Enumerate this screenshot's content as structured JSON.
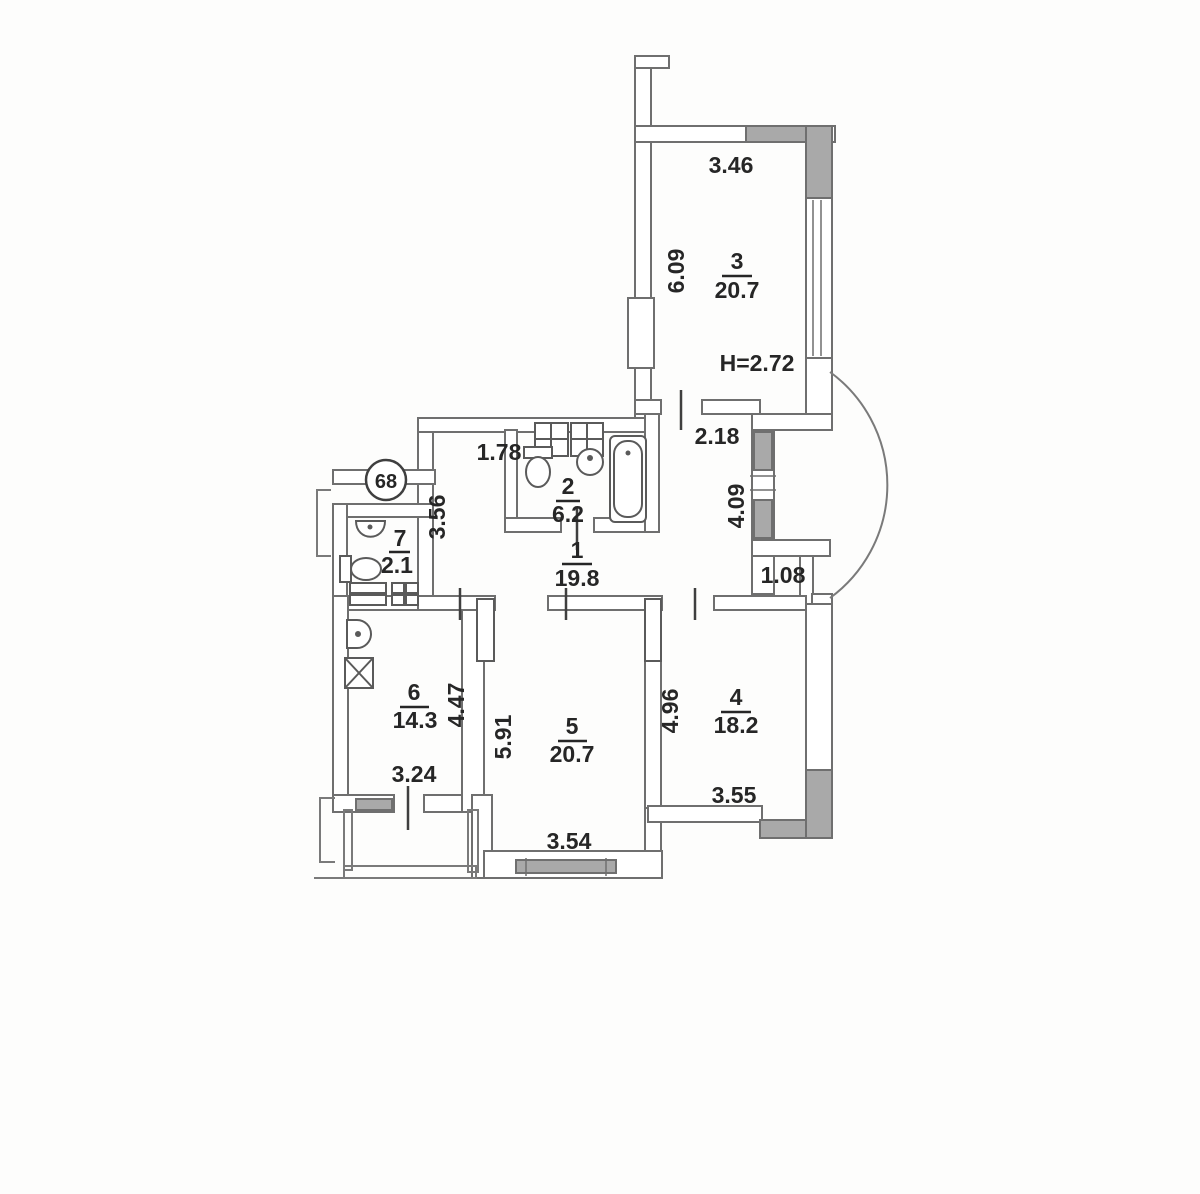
{
  "plan": {
    "apartment_number": "68",
    "ceiling_height": "H=2.72",
    "rooms": {
      "r1": {
        "number": "1",
        "area": "19.8"
      },
      "r2": {
        "number": "2",
        "area": "6.2"
      },
      "r3": {
        "number": "3",
        "area": "20.7"
      },
      "r4": {
        "number": "4",
        "area": "18.2"
      },
      "r5": {
        "number": "5",
        "area": "20.7"
      },
      "r6": {
        "number": "6",
        "area": "14.3"
      },
      "r7": {
        "number": "7",
        "area": "2.1"
      }
    },
    "dims": {
      "d346": "3.46",
      "d609": "6.09",
      "d218": "2.18",
      "d409": "4.09",
      "d108": "1.08",
      "d178": "1.78",
      "d356": "3.56",
      "d447": "4.47",
      "d324": "3.24",
      "d591": "5.91",
      "d354": "3.54",
      "d496": "4.96",
      "d355": "3.55"
    },
    "colors": {
      "wall_hatch": "#a9a9a9",
      "line": "#6f6f6f",
      "text": "#262626"
    }
  }
}
